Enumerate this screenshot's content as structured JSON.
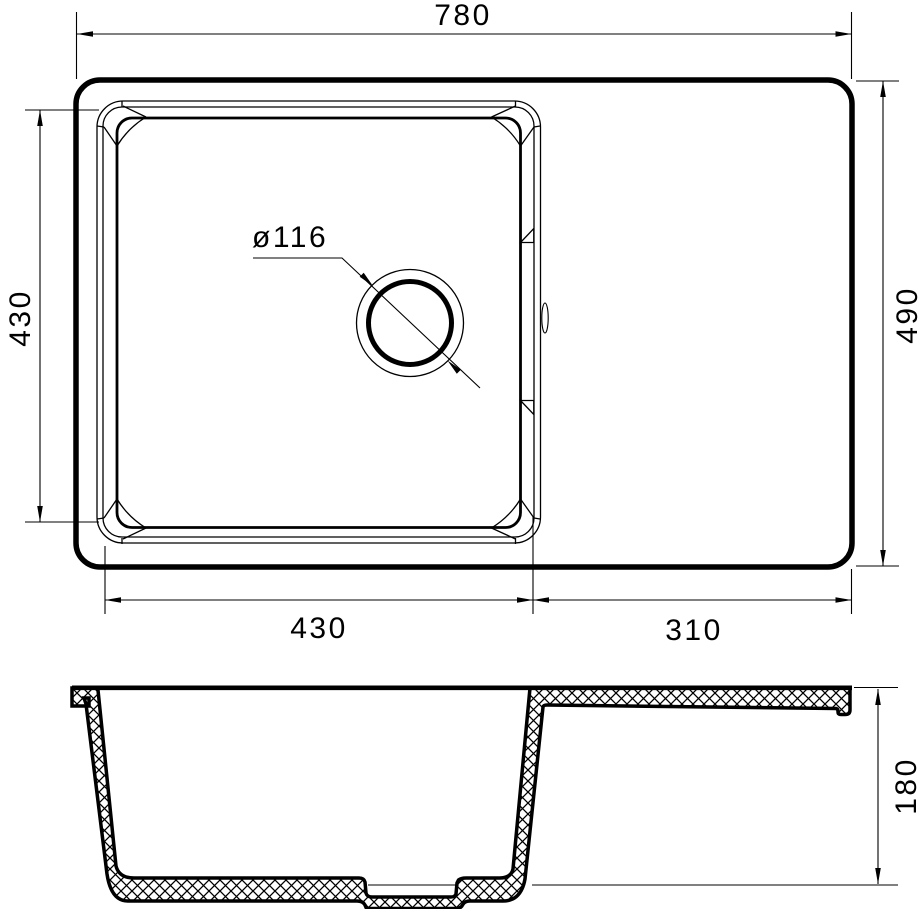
{
  "drawing": {
    "type": "kitchen-sink-technical-drawing",
    "colors": {
      "line": "#000000",
      "background": "#ffffff"
    },
    "top_view": {
      "overall_width_label": "780",
      "overall_depth_label": "490",
      "bowl_height_label": "430",
      "bowl_width_label": "430",
      "drainboard_width_label": "310",
      "drain_diameter_label": "ø116"
    },
    "section_view": {
      "bowl_depth_label": "180"
    }
  }
}
